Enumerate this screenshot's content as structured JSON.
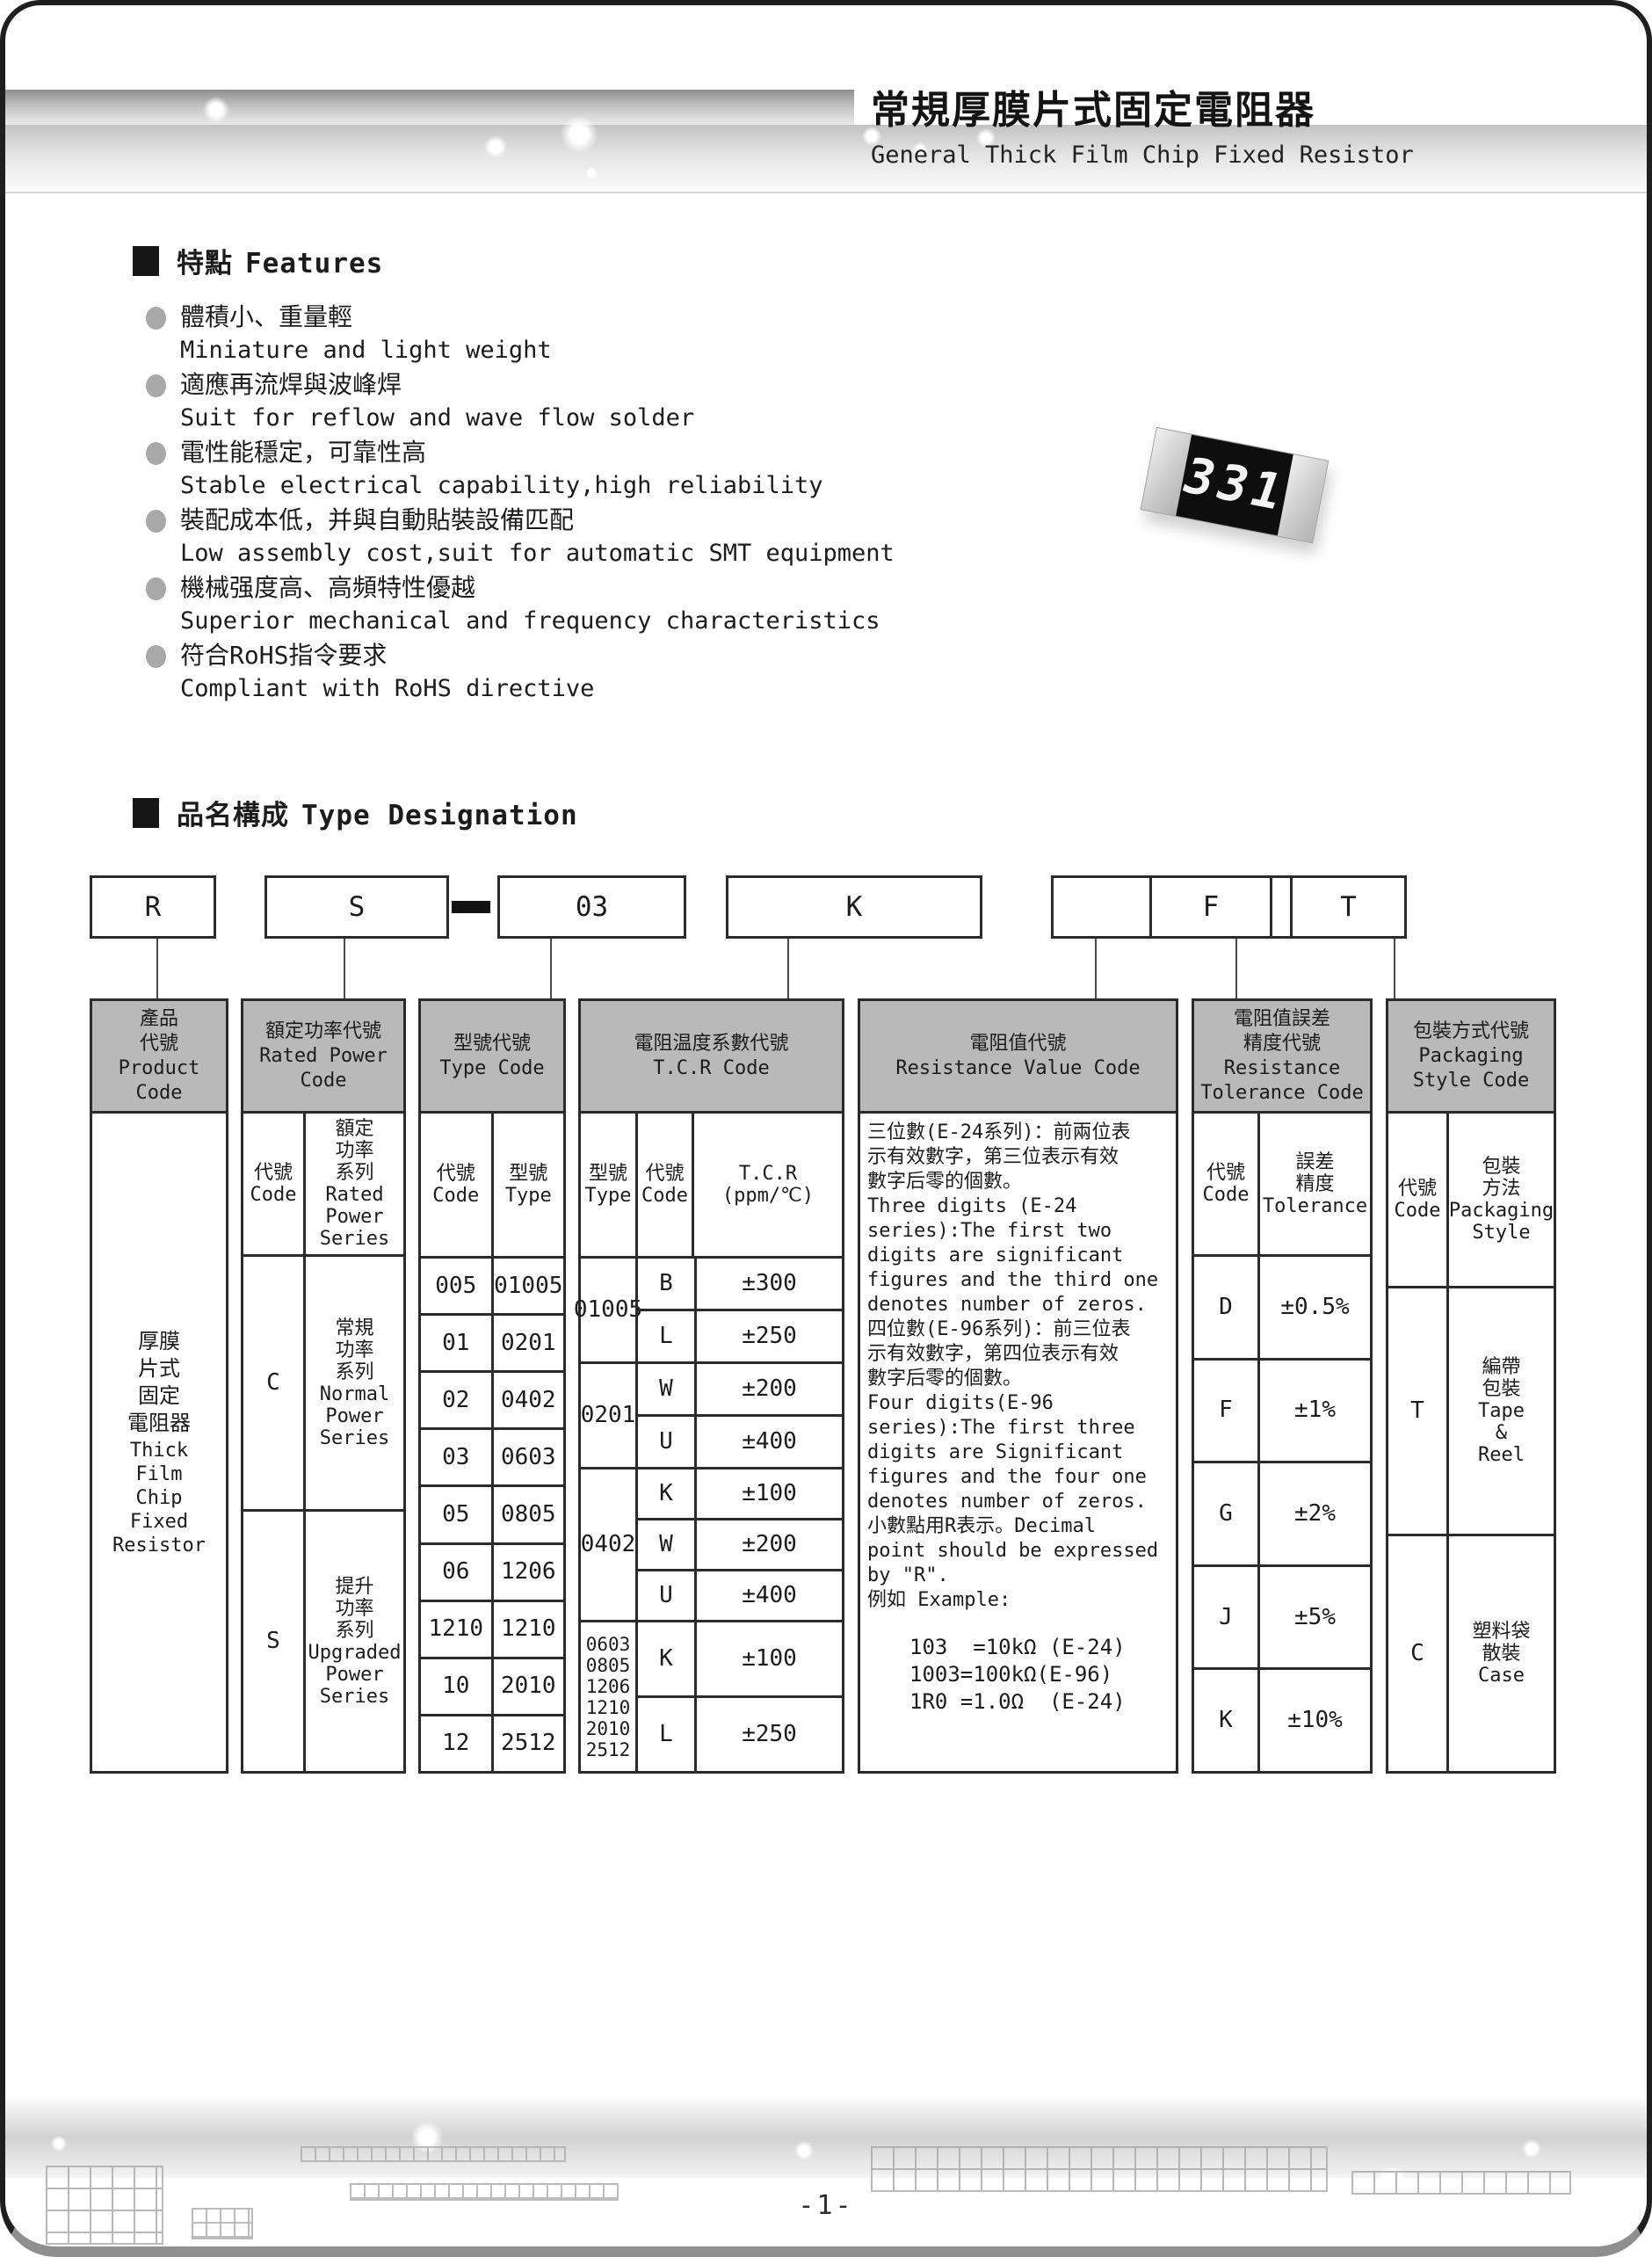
{
  "header": {
    "title_zh": "常規厚膜片式固定電阻器",
    "title_en": "General Thick Film Chip Fixed Resistor"
  },
  "features": {
    "heading_zh": "特點",
    "heading_en": "Features",
    "items": [
      {
        "zh": "體積小、重量輕",
        "en": "Miniature and light weight"
      },
      {
        "zh": "適應再流焊與波峰焊",
        "en": "Suit for reflow and wave flow solder"
      },
      {
        "zh": "電性能穩定，可靠性高",
        "en": "Stable electrical capability,high reliability"
      },
      {
        "zh": "裝配成本低，并與自動貼裝設備匹配",
        "en": "Low assembly cost,suit for automatic SMT equipment"
      },
      {
        "zh": "機械强度高、高頻特性優越",
        "en": "Superior mechanical and frequency characteristics"
      },
      {
        "zh": "符合RoHS指令要求",
        "en": "Compliant with RoHS directive"
      }
    ]
  },
  "resistor": {
    "marking": "331"
  },
  "type_designation": {
    "heading_zh": "品名構成",
    "heading_en": "Type Designation",
    "codes": {
      "product": "R",
      "power": "S",
      "type": "03",
      "tcr": "K",
      "value": "1003",
      "tolerance": "F",
      "packaging": "T"
    },
    "table": {
      "col1": {
        "header": "產品\n代號\nProduct\nCode",
        "body_zh": "厚膜\n片式\n固定\n電阻器",
        "body_en": "Thick\nFilm\nChip\nFixed\nResistor"
      },
      "col2": {
        "header": "額定功率代號\nRated Power\nCode",
        "sub_code": "代號\nCode",
        "sub_series": "額定\n功率\n系列\nRated\nPower\nSeries",
        "rows": [
          {
            "code": "C",
            "series": "常規\n功率\n系列\nNormal\nPower\nSeries"
          },
          {
            "code": "S",
            "series": "提升\n功率\n系列\nUpgraded\nPower\nSeries"
          }
        ]
      },
      "col3": {
        "header": "型號代號\nType Code",
        "sub_code": "代號\nCode",
        "sub_type": "型號\nType",
        "rows": [
          [
            "005",
            "01005"
          ],
          [
            "01",
            "0201"
          ],
          [
            "02",
            "0402"
          ],
          [
            "03",
            "0603"
          ],
          [
            "05",
            "0805"
          ],
          [
            "06",
            "1206"
          ],
          [
            "1210",
            "1210"
          ],
          [
            "10",
            "2010"
          ],
          [
            "12",
            "2512"
          ]
        ]
      },
      "col4": {
        "header": "電阻温度系數代號\nT.C.R Code",
        "sub_type": "型號\nType",
        "sub_code": "代號\nCode",
        "sub_tcr": "T.C.R\n(ppm/℃)",
        "groups": [
          {
            "type": "01005",
            "rows": [
              [
                "B",
                "±300"
              ],
              [
                "L",
                "±250"
              ]
            ]
          },
          {
            "type": "0201",
            "rows": [
              [
                "W",
                "±200"
              ],
              [
                "U",
                "±400"
              ]
            ]
          },
          {
            "type": "0402",
            "rows": [
              [
                "K",
                "±100"
              ],
              [
                "W",
                "±200"
              ],
              [
                "U",
                "±400"
              ]
            ]
          },
          {
            "type": "0603\n0805\n1206\n1210\n2010\n2512",
            "rows": [
              [
                "K",
                "±100"
              ],
              [
                "L",
                "±250"
              ]
            ]
          }
        ]
      },
      "col5": {
        "header": "電阻值代號\nResistance Value Code",
        "body": "三位數(E-24系列)：前兩位表\n示有效數字，第三位表示有效\n數字后零的個數。\nThree digits (E-24\nseries):The first two\ndigits are significant\nfigures and the third one\ndenotes number of zeros.\n四位數(E-96系列)：前三位表\n示有效數字，第四位表示有效\n數字后零的個數。\nFour digits(E-96\nseries):The first three\ndigits are Significant\nfigures and the four one\ndenotes number of zeros.\n小數點用R表示。Decimal\npoint should be expressed\nby \"R\".\n例如 Example:",
        "examples": "103  =10kΩ (E-24)\n1003=100kΩ(E-96)\n1R0 =1.0Ω  (E-24)"
      },
      "col6": {
        "header": "電阻值誤差\n精度代號\nResistance\nTolerance Code",
        "sub_code": "代號\nCode",
        "sub_tol": "誤差\n精度\nTolerance",
        "rows": [
          [
            "D",
            "±0.5%"
          ],
          [
            "F",
            "±1%"
          ],
          [
            "G",
            "±2%"
          ],
          [
            "J",
            "±5%"
          ],
          [
            "K",
            "±10%"
          ]
        ]
      },
      "col7": {
        "header": "包裝方式代號\nPackaging\nStyle Code",
        "sub_code": "代號\nCode",
        "sub_style": "包裝\n方法\nPackaging\nStyle",
        "rows": [
          {
            "code": "T",
            "style": "編帶\n包裝\nTape\n&\nReel"
          },
          {
            "code": "C",
            "style": "塑料袋\n散裝\nCase"
          }
        ]
      }
    }
  },
  "footer": {
    "page_number": "-1-"
  }
}
